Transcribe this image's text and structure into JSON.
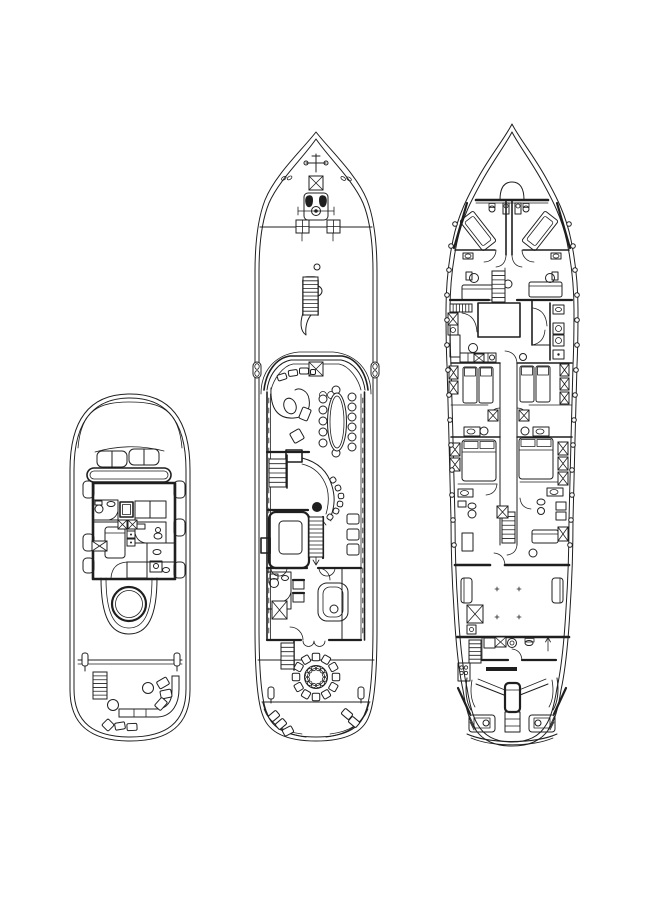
{
  "drawing": {
    "background": "#ffffff",
    "ink": "#1f1f1f",
    "canvas_width": 651,
    "canvas_height": 920
  },
  "decks": [
    {
      "key": "sun_deck",
      "name": "sun-deck-plan"
    },
    {
      "key": "main_deck",
      "name": "main-deck-plan"
    },
    {
      "key": "lower_deck",
      "name": "lower-deck-plan"
    }
  ],
  "fittings": {
    "ladders": [
      {
        "x": 93,
        "y": 672,
        "w": 14,
        "h": 27,
        "rungs": 7
      },
      {
        "x": 303,
        "y": 277,
        "w": 15,
        "h": 38,
        "rungs": 10
      },
      {
        "x": 269,
        "y": 459,
        "w": 17,
        "h": 28,
        "rungs": 6
      },
      {
        "x": 309,
        "y": 517,
        "w": 14,
        "h": 40,
        "rungs": 10
      },
      {
        "x": 281,
        "y": 643,
        "w": 13,
        "h": 26,
        "rungs": 6
      },
      {
        "x": 492,
        "y": 271,
        "w": 13,
        "h": 31,
        "rungs": 7
      },
      {
        "x": 502,
        "y": 512,
        "w": 13,
        "h": 31,
        "rungs": 7
      },
      {
        "x": 469,
        "y": 640,
        "w": 12,
        "h": 23,
        "rungs": 6
      }
    ],
    "x_hatches": [
      {
        "x": 118,
        "y": 520,
        "w": 9,
        "h": 9
      },
      {
        "x": 128,
        "y": 520,
        "w": 9,
        "h": 9
      },
      {
        "x": 92,
        "y": 541,
        "w": 15,
        "h": 10
      },
      {
        "x": 309,
        "y": 176,
        "w": 14,
        "h": 14
      },
      {
        "x": 309,
        "y": 362,
        "w": 14,
        "h": 14
      },
      {
        "x": 272,
        "y": 601,
        "w": 15,
        "h": 18
      },
      {
        "x": 448,
        "y": 313,
        "w": 10,
        "h": 12
      },
      {
        "x": 449,
        "y": 366,
        "w": 9,
        "h": 13
      },
      {
        "x": 449,
        "y": 381,
        "w": 9,
        "h": 13
      },
      {
        "x": 450,
        "y": 443,
        "w": 10,
        "h": 13
      },
      {
        "x": 450,
        "y": 458,
        "w": 10,
        "h": 13
      },
      {
        "x": 560,
        "y": 364,
        "w": 9,
        "h": 12
      },
      {
        "x": 560,
        "y": 378,
        "w": 9,
        "h": 12
      },
      {
        "x": 560,
        "y": 392,
        "w": 9,
        "h": 12
      },
      {
        "x": 558,
        "y": 442,
        "w": 10,
        "h": 13
      },
      {
        "x": 558,
        "y": 457,
        "w": 10,
        "h": 13
      },
      {
        "x": 558,
        "y": 472,
        "w": 10,
        "h": 13
      },
      {
        "x": 558,
        "y": 527,
        "w": 10,
        "h": 14
      },
      {
        "x": 488,
        "y": 410,
        "w": 10,
        "h": 11
      },
      {
        "x": 519,
        "y": 410,
        "w": 10,
        "h": 11
      },
      {
        "x": 497,
        "y": 506,
        "w": 11,
        "h": 12
      },
      {
        "x": 474,
        "y": 354,
        "w": 10,
        "h": 8
      },
      {
        "x": 495,
        "y": 637,
        "w": 11,
        "h": 10
      },
      {
        "x": 467,
        "y": 605,
        "w": 16,
        "h": 18
      }
    ],
    "cross_bitts": [
      {
        "x": 296,
        "y": 220,
        "s": 13
      },
      {
        "x": 327,
        "y": 220,
        "s": 13
      }
    ],
    "grills": [
      {
        "x": 450,
        "y": 304,
        "w": 22,
        "h": 8,
        "n": 7
      }
    ],
    "fenders": {
      "r": 2.3,
      "points": [
        [
          455,
          224
        ],
        [
          451,
          246
        ],
        [
          449,
          270
        ],
        [
          447,
          295
        ],
        [
          447,
          320
        ],
        [
          447,
          345
        ],
        [
          448,
          370
        ],
        [
          449,
          395
        ],
        [
          450,
          420
        ],
        [
          451,
          445
        ],
        [
          452,
          470
        ],
        [
          452,
          495
        ],
        [
          453,
          520
        ],
        [
          454,
          545
        ],
        [
          569,
          224
        ],
        [
          573,
          246
        ],
        [
          575,
          270
        ],
        [
          577,
          295
        ],
        [
          577,
          320
        ],
        [
          577,
          345
        ],
        [
          576,
          370
        ],
        [
          575,
          395
        ],
        [
          574,
          420
        ],
        [
          573,
          445
        ],
        [
          572,
          470
        ],
        [
          572,
          495
        ],
        [
          571,
          520
        ],
        [
          570,
          545
        ]
      ]
    },
    "small_rects": [
      {
        "x": 163,
        "y": 683,
        "w": 11,
        "h": 8,
        "a": -30
      },
      {
        "x": 166,
        "y": 694,
        "w": 11,
        "h": 8,
        "a": -12
      },
      {
        "x": 161,
        "y": 704,
        "w": 11,
        "h": 8,
        "a": -48
      },
      {
        "x": 108,
        "y": 725,
        "w": 9,
        "h": 9,
        "a": 45
      },
      {
        "x": 120,
        "y": 726,
        "w": 10,
        "h": 7,
        "a": -10
      },
      {
        "x": 132,
        "y": 727,
        "w": 10,
        "h": 7,
        "a": -3
      },
      {
        "x": 274,
        "y": 716,
        "w": 10,
        "h": 7,
        "a": -40
      },
      {
        "x": 281,
        "y": 724,
        "w": 10,
        "h": 7,
        "a": -40
      },
      {
        "x": 288,
        "y": 731,
        "w": 10,
        "h": 7,
        "a": -28
      },
      {
        "x": 347,
        "y": 714,
        "w": 10,
        "h": 7,
        "a": 40
      },
      {
        "x": 354,
        "y": 722,
        "w": 10,
        "h": 7,
        "a": 40
      },
      {
        "x": 282,
        "y": 377,
        "w": 9,
        "h": 6,
        "a": -18
      },
      {
        "x": 293,
        "y": 373,
        "w": 9,
        "h": 6,
        "a": -8
      },
      {
        "x": 304,
        "y": 371,
        "w": 9,
        "h": 6,
        "a": 0
      },
      {
        "x": 313,
        "y": 372,
        "w": 5,
        "h": 5,
        "a": 0
      },
      {
        "x": 305,
        "y": 414,
        "w": 9,
        "h": 12,
        "a": 22
      },
      {
        "x": 297,
        "y": 436,
        "w": 11,
        "h": 11,
        "a": -30
      }
    ],
    "round_table": {
      "cx": 316,
      "cy": 677,
      "r_outer": 11.5,
      "r_inner": 8.5,
      "chairs": 12,
      "chair_ring": 20,
      "chair_size": 7.5,
      "plates": 12,
      "plate_ring": 8.8,
      "plate_r": 2.2
    },
    "oval_table": {
      "cx": 337,
      "cy": 422,
      "rx": 9.5,
      "ry": 29,
      "irx": 7,
      "iry": 26,
      "chair_r": 4,
      "left_x": 323,
      "left_ys": [
        399,
        410,
        421,
        432,
        443
      ],
      "right_x": 352,
      "right_ys": [
        397,
        407,
        417,
        427,
        437,
        447
      ],
      "top": [
        336,
        390
      ],
      "bottom": [
        336,
        453
      ]
    },
    "bar_stools": {
      "center": [
        305,
        499
      ],
      "size": 5.5,
      "points": [
        [
          333,
          480
        ],
        [
          338,
          488
        ],
        [
          341,
          496
        ],
        [
          340,
          504
        ],
        [
          336,
          511
        ],
        [
          330,
          517
        ]
      ]
    },
    "plus_marks": [
      [
        497,
        589
      ],
      [
        519,
        589
      ],
      [
        497,
        617
      ],
      [
        519,
        617
      ]
    ]
  }
}
